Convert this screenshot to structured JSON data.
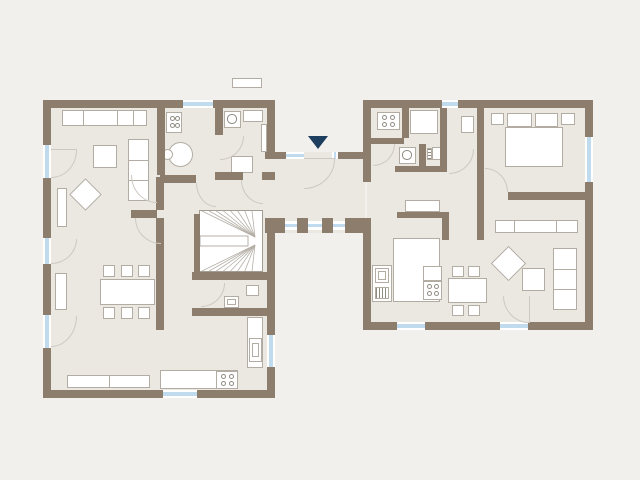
{
  "meta": {
    "description": "architectural floor plan, two building wings joined by a glazed entrance corridor",
    "visible_text": []
  },
  "canvas": {
    "width": 640,
    "height": 480
  },
  "colors": {
    "background": "#f2f0ec",
    "floor": "#ebe8e2",
    "wall": "#8c7d6d",
    "window_glass": "#bfdbed",
    "window_frame": "#ffffff",
    "furniture_fill": "#ffffff",
    "furniture_border": "#b2aca3",
    "symbol_line": "#8f8a82",
    "door_arc": "#cdc8c1",
    "entrance_arrow": "#1e3e5f",
    "stair_line": "#b5afa6",
    "stair_border": "#a39c93"
  },
  "elements": [
    {
      "t": "floor",
      "n": "left-building-floor",
      "x": 47,
      "y": 104,
      "w": 224,
      "h": 290
    },
    {
      "t": "floor",
      "n": "link-corridor-floor",
      "x": 265,
      "y": 152,
      "w": 100,
      "h": 81
    },
    {
      "t": "floor",
      "n": "right-building-floor",
      "x": 367,
      "y": 104,
      "w": 222,
      "h": 222
    },
    {
      "t": "seg",
      "n": "living-sofa",
      "x": 62,
      "y": 110,
      "w": 85,
      "h": 16,
      "dir": "v",
      "segs": [
        0.24,
        0.65,
        0.84
      ]
    },
    {
      "t": "seg",
      "n": "living-sofa-chaise",
      "x": 128,
      "y": 139,
      "w": 21,
      "h": 62,
      "dir": "h",
      "segs": [
        0.33,
        0.66
      ]
    },
    {
      "t": "rect",
      "n": "living-coffee-table",
      "x": 93,
      "y": 145,
      "w": 24,
      "h": 23
    },
    {
      "t": "diamond",
      "n": "living-armchair",
      "x": 74,
      "y": 183,
      "w": 23,
      "h": 23
    },
    {
      "t": "rect",
      "n": "living-radiator",
      "x": 57,
      "y": 188,
      "w": 10,
      "h": 39
    },
    {
      "t": "stove",
      "n": "kitchen1-stove",
      "x": 166,
      "y": 112,
      "w": 16,
      "h": 21
    },
    {
      "t": "circle",
      "n": "kitchen1-round-table",
      "x": 168,
      "y": 142,
      "w": 25,
      "h": 25
    },
    {
      "t": "circle",
      "n": "kitchen1-chair",
      "x": 162,
      "y": 149,
      "w": 11,
      "h": 11
    },
    {
      "t": "washer",
      "n": "utility-washing-machine",
      "x": 224,
      "y": 111,
      "w": 17,
      "h": 17
    },
    {
      "t": "rect",
      "n": "utility-counter",
      "x": 243,
      "y": 110,
      "w": 20,
      "h": 12
    },
    {
      "t": "rect",
      "n": "utility-table",
      "x": 231,
      "y": 156,
      "w": 22,
      "h": 17
    },
    {
      "t": "rect",
      "n": "utility-radiator",
      "x": 261,
      "y": 124,
      "w": 6,
      "h": 28
    },
    {
      "t": "rect",
      "n": "dining-shelf",
      "x": 55,
      "y": 273,
      "w": 12,
      "h": 37
    },
    {
      "t": "rect",
      "n": "dining-table",
      "x": 100,
      "y": 279,
      "w": 55,
      "h": 26
    },
    {
      "t": "rect",
      "n": "dining-chair",
      "x": 103,
      "y": 265,
      "w": 12,
      "h": 12
    },
    {
      "t": "rect",
      "n": "dining-chair",
      "x": 121,
      "y": 265,
      "w": 12,
      "h": 12
    },
    {
      "t": "rect",
      "n": "dining-chair",
      "x": 138,
      "y": 265,
      "w": 12,
      "h": 12
    },
    {
      "t": "rect",
      "n": "dining-chair",
      "x": 103,
      "y": 307,
      "w": 12,
      "h": 12
    },
    {
      "t": "rect",
      "n": "dining-chair",
      "x": 121,
      "y": 307,
      "w": 12,
      "h": 12
    },
    {
      "t": "rect",
      "n": "dining-chair",
      "x": 138,
      "y": 307,
      "w": 12,
      "h": 12
    },
    {
      "t": "seg",
      "n": "dining-sideboard",
      "x": 67,
      "y": 375,
      "w": 83,
      "h": 13,
      "dir": "v",
      "segs": [
        0.5
      ]
    },
    {
      "t": "stairs",
      "n": "staircase",
      "x": 199,
      "y": 210,
      "w": 64,
      "h": 62
    },
    {
      "t": "rect",
      "n": "wc-sink",
      "x": 246,
      "y": 285,
      "w": 13,
      "h": 11
    },
    {
      "t": "inner",
      "n": "wc-toilet",
      "x": 224,
      "y": 296,
      "w": 15,
      "h": 12
    },
    {
      "t": "rect",
      "n": "kitchen2-counter-right",
      "x": 247,
      "y": 317,
      "w": 16,
      "h": 51
    },
    {
      "t": "inner",
      "n": "kitchen2-sink",
      "x": 249,
      "y": 338,
      "w": 13,
      "h": 24
    },
    {
      "t": "rect",
      "n": "kitchen2-counter-bottom",
      "x": 160,
      "y": 370,
      "w": 78,
      "h": 19
    },
    {
      "t": "stove",
      "n": "kitchen2-stove",
      "x": 216,
      "y": 371,
      "w": 22,
      "h": 18
    },
    {
      "t": "rect",
      "n": "roof-dormer",
      "x": 232,
      "y": 78,
      "w": 30,
      "h": 10
    },
    {
      "t": "triangle",
      "n": "entrance-arrow-icon",
      "x": 308,
      "y": 136,
      "w": 20,
      "h": 13
    },
    {
      "t": "stove",
      "n": "kitchen3-stove",
      "x": 377,
      "y": 112,
      "w": 23,
      "h": 18
    },
    {
      "t": "rect",
      "n": "hwr-counter",
      "x": 410,
      "y": 110,
      "w": 28,
      "h": 24
    },
    {
      "t": "grille",
      "n": "hwr-radiator1",
      "x": 404,
      "y": 113,
      "w": 5,
      "h": 16,
      "dir": "h"
    },
    {
      "t": "washer",
      "n": "hwr-washing-machine",
      "x": 399,
      "y": 147,
      "w": 17,
      "h": 17
    },
    {
      "t": "grille",
      "n": "hwr-radiator2",
      "x": 427,
      "y": 148,
      "w": 5,
      "h": 12,
      "dir": "h"
    },
    {
      "t": "rect",
      "n": "hwr-appliance",
      "x": 432,
      "y": 147,
      "w": 14,
      "h": 13
    },
    {
      "t": "rect",
      "n": "bath-shower",
      "x": 461,
      "y": 116,
      "w": 13,
      "h": 17
    },
    {
      "t": "rect",
      "n": "bedroom-nightstand-left",
      "x": 491,
      "y": 113,
      "w": 13,
      "h": 12
    },
    {
      "t": "rect",
      "n": "bedroom-pillow-left",
      "x": 507,
      "y": 113,
      "w": 25,
      "h": 14
    },
    {
      "t": "rect",
      "n": "bedroom-pillow-right",
      "x": 535,
      "y": 113,
      "w": 23,
      "h": 14
    },
    {
      "t": "rect",
      "n": "bedroom-nightstand-right",
      "x": 561,
      "y": 113,
      "w": 14,
      "h": 12
    },
    {
      "t": "rect",
      "n": "bedroom-bed",
      "x": 505,
      "y": 127,
      "w": 58,
      "h": 40
    },
    {
      "t": "rect",
      "n": "hall-bench",
      "x": 405,
      "y": 200,
      "w": 35,
      "h": 12
    },
    {
      "t": "rect",
      "n": "kitchen3-fridge-unit",
      "x": 372,
      "y": 265,
      "w": 20,
      "h": 37
    },
    {
      "t": "inner",
      "n": "kitchen3-fridge",
      "x": 375,
      "y": 268,
      "w": 14,
      "h": 15
    },
    {
      "t": "grille",
      "n": "kitchen3-vent-grille",
      "x": 375,
      "y": 287,
      "w": 14,
      "h": 12,
      "dir": "v"
    },
    {
      "t": "rect",
      "n": "kitchen3-counter",
      "x": 393,
      "y": 238,
      "w": 47,
      "h": 64
    },
    {
      "t": "rect",
      "n": "kitchen3-stove-panel",
      "x": 423,
      "y": 266,
      "w": 19,
      "h": 15
    },
    {
      "t": "stove",
      "n": "kitchen3-cooktop",
      "x": 423,
      "y": 281,
      "w": 19,
      "h": 19
    },
    {
      "t": "rect",
      "n": "dining2-table",
      "x": 448,
      "y": 278,
      "w": 39,
      "h": 25
    },
    {
      "t": "rect",
      "n": "dining2-chair",
      "x": 452,
      "y": 266,
      "w": 12,
      "h": 11
    },
    {
      "t": "rect",
      "n": "dining2-chair",
      "x": 468,
      "y": 266,
      "w": 12,
      "h": 11
    },
    {
      "t": "rect",
      "n": "dining2-chair",
      "x": 452,
      "y": 305,
      "w": 12,
      "h": 11
    },
    {
      "t": "rect",
      "n": "dining2-chair",
      "x": 468,
      "y": 305,
      "w": 12,
      "h": 11
    },
    {
      "t": "seg",
      "n": "living2-wardrobe",
      "x": 495,
      "y": 220,
      "w": 83,
      "h": 13,
      "dir": "v",
      "segs": [
        0.22,
        0.74
      ]
    },
    {
      "t": "diamond",
      "n": "living2-armchair",
      "x": 496,
      "y": 251,
      "w": 25,
      "h": 25
    },
    {
      "t": "rect",
      "n": "living2-coffee-table",
      "x": 522,
      "y": 268,
      "w": 23,
      "h": 23
    },
    {
      "t": "seg",
      "n": "living2-sofa",
      "x": 553,
      "y": 248,
      "w": 24,
      "h": 62,
      "dir": "h",
      "segs": [
        0.33,
        0.66
      ]
    },
    {
      "t": "wall",
      "n": "wall-lb-top",
      "x": 43,
      "y": 100,
      "w": 232,
      "h": 8
    },
    {
      "t": "wall",
      "n": "wall-lb-left",
      "x": 43,
      "y": 100,
      "w": 8,
      "h": 298
    },
    {
      "t": "wall",
      "n": "wall-lb-bottom",
      "x": 43,
      "y": 390,
      "w": 232,
      "h": 8
    },
    {
      "t": "wall",
      "n": "wall-lb-right-upper",
      "x": 267,
      "y": 108,
      "w": 8,
      "h": 44
    },
    {
      "t": "wall",
      "n": "wall-lb-right-lower",
      "x": 267,
      "y": 233,
      "w": 8,
      "h": 157
    },
    {
      "t": "wall",
      "n": "wall-kitchen1-divider",
      "x": 157,
      "y": 108,
      "w": 8,
      "h": 67
    },
    {
      "t": "wall",
      "n": "wall-utility-divider",
      "x": 215,
      "y": 108,
      "w": 8,
      "h": 27
    },
    {
      "t": "wall",
      "n": "wall-utility-south-a",
      "x": 215,
      "y": 172,
      "w": 28,
      "h": 8
    },
    {
      "t": "wall",
      "n": "wall-utility-south-b",
      "x": 262,
      "y": 172,
      "w": 13,
      "h": 8
    },
    {
      "t": "wall",
      "n": "wall-hall-north",
      "x": 160,
      "y": 175,
      "w": 36,
      "h": 8
    },
    {
      "t": "wall",
      "n": "wall-living-dining",
      "x": 131,
      "y": 210,
      "w": 26,
      "h": 8
    },
    {
      "t": "wall",
      "n": "wall-spine-upper",
      "x": 156,
      "y": 177,
      "w": 8,
      "h": 33
    },
    {
      "t": "wall",
      "n": "wall-spine-lower",
      "x": 156,
      "y": 218,
      "w": 8,
      "h": 112
    },
    {
      "t": "wall",
      "n": "wall-stair-west",
      "x": 194,
      "y": 214,
      "w": 6,
      "h": 58
    },
    {
      "t": "wall",
      "n": "wall-stair-south",
      "x": 192,
      "y": 272,
      "w": 83,
      "h": 8
    },
    {
      "t": "wall",
      "n": "wall-wc-south",
      "x": 192,
      "y": 308,
      "w": 83,
      "h": 8
    },
    {
      "t": "wall",
      "n": "wall-corridor-stub-left",
      "x": 265,
      "y": 152,
      "w": 21,
      "h": 7
    },
    {
      "t": "wall",
      "n": "wall-corridor-stub-right",
      "x": 338,
      "y": 152,
      "w": 27,
      "h": 7
    },
    {
      "t": "wall",
      "n": "wall-corridor-pillar1",
      "x": 265,
      "y": 218,
      "w": 20,
      "h": 15
    },
    {
      "t": "wall",
      "n": "wall-corridor-pillar2",
      "x": 297,
      "y": 218,
      "w": 11,
      "h": 15
    },
    {
      "t": "wall",
      "n": "wall-corridor-pillar3",
      "x": 322,
      "y": 218,
      "w": 11,
      "h": 15
    },
    {
      "t": "wall",
      "n": "wall-corridor-pillar4",
      "x": 345,
      "y": 218,
      "w": 20,
      "h": 15
    },
    {
      "t": "wall",
      "n": "wall-rb-top",
      "x": 363,
      "y": 100,
      "w": 230,
      "h": 8
    },
    {
      "t": "wall",
      "n": "wall-rb-left-upper",
      "x": 363,
      "y": 100,
      "w": 8,
      "h": 82
    },
    {
      "t": "wall",
      "n": "wall-rb-left-lower",
      "x": 363,
      "y": 218,
      "w": 8,
      "h": 112
    },
    {
      "t": "wall",
      "n": "wall-rb-right",
      "x": 585,
      "y": 100,
      "w": 8,
      "h": 230
    },
    {
      "t": "wall",
      "n": "wall-rb-bottom",
      "x": 363,
      "y": 322,
      "w": 230,
      "h": 8
    },
    {
      "t": "wall",
      "n": "wall-hwr-divider1",
      "x": 402,
      "y": 108,
      "w": 7,
      "h": 30
    },
    {
      "t": "wall",
      "n": "wall-hwr-h1",
      "x": 371,
      "y": 138,
      "w": 33,
      "h": 6
    },
    {
      "t": "wall",
      "n": "wall-hwr-divider2",
      "x": 419,
      "y": 144,
      "w": 7,
      "h": 22
    },
    {
      "t": "wall",
      "n": "wall-hwr-h2",
      "x": 395,
      "y": 166,
      "w": 45,
      "h": 6
    },
    {
      "t": "wall",
      "n": "wall-bath-west",
      "x": 440,
      "y": 108,
      "w": 7,
      "h": 64
    },
    {
      "t": "wall",
      "n": "wall-rb-spine",
      "x": 477,
      "y": 108,
      "w": 7,
      "h": 132
    },
    {
      "t": "wall",
      "n": "wall-bedroom-south",
      "x": 508,
      "y": 192,
      "w": 85,
      "h": 8
    },
    {
      "t": "wall",
      "n": "wall-hall2-south",
      "x": 397,
      "y": 212,
      "w": 52,
      "h": 6
    },
    {
      "t": "wall",
      "n": "wall-hall2-east",
      "x": 442,
      "y": 212,
      "w": 7,
      "h": 28
    },
    {
      "t": "window",
      "n": "window-lb-top",
      "x": 183,
      "y": 100,
      "w": 30,
      "h": 8
    },
    {
      "t": "window",
      "n": "window-lb-left1",
      "x": 43,
      "y": 145,
      "w": 8,
      "h": 33
    },
    {
      "t": "window",
      "n": "window-lb-left2",
      "x": 43,
      "y": 238,
      "w": 8,
      "h": 26
    },
    {
      "t": "window",
      "n": "window-lb-left3",
      "x": 43,
      "y": 315,
      "w": 8,
      "h": 33
    },
    {
      "t": "window",
      "n": "window-lb-bottom",
      "x": 163,
      "y": 390,
      "w": 34,
      "h": 8
    },
    {
      "t": "window",
      "n": "window-lb-right",
      "x": 267,
      "y": 335,
      "w": 8,
      "h": 32
    },
    {
      "t": "window",
      "n": "entrance-sidelight-left",
      "x": 286,
      "y": 152,
      "w": 18,
      "h": 7
    },
    {
      "t": "window",
      "n": "entrance-sidelight-right",
      "x": 332,
      "y": 152,
      "w": 6,
      "h": 7
    },
    {
      "t": "window",
      "n": "corridor-window1",
      "x": 285,
      "y": 221,
      "w": 12,
      "h": 9
    },
    {
      "t": "window",
      "n": "corridor-window2",
      "x": 308,
      "y": 221,
      "w": 14,
      "h": 9
    },
    {
      "t": "window",
      "n": "corridor-window3",
      "x": 333,
      "y": 221,
      "w": 12,
      "h": 9
    },
    {
      "t": "window",
      "n": "window-rb-top",
      "x": 442,
      "y": 100,
      "w": 16,
      "h": 8
    },
    {
      "t": "window",
      "n": "window-rb-right",
      "x": 585,
      "y": 137,
      "w": 8,
      "h": 45
    },
    {
      "t": "window",
      "n": "window-rb-bottom",
      "x": 397,
      "y": 322,
      "w": 28,
      "h": 8
    },
    {
      "t": "window",
      "n": "door-rb-bottom-glass",
      "x": 500,
      "y": 322,
      "w": 28,
      "h": 8
    },
    {
      "t": "line",
      "n": "door-leaf",
      "x": 51,
      "y": 149,
      "w": 26,
      "h": 1
    },
    {
      "t": "arc",
      "n": "door-arc",
      "x": 51,
      "y": 150,
      "w": 26,
      "h": 28,
      "c": "br"
    },
    {
      "t": "arc",
      "n": "door-arc",
      "x": 51,
      "y": 239,
      "w": 26,
      "h": 25,
      "c": "br"
    },
    {
      "t": "arc",
      "n": "door-arc",
      "x": 51,
      "y": 316,
      "w": 26,
      "h": 31,
      "c": "br"
    },
    {
      "t": "arc",
      "n": "door-arc",
      "x": 131,
      "y": 175,
      "w": 26,
      "h": 28,
      "c": "bl"
    },
    {
      "t": "arc",
      "n": "door-arc",
      "x": 220,
      "y": 136,
      "w": 24,
      "h": 24,
      "c": "br"
    },
    {
      "t": "arc",
      "n": "door-arc",
      "x": 241,
      "y": 180,
      "w": 22,
      "h": 24,
      "c": "bl"
    },
    {
      "t": "arc",
      "n": "door-arc",
      "x": 196,
      "y": 183,
      "w": 20,
      "h": 24,
      "c": "bl"
    },
    {
      "t": "arc",
      "n": "door-arc",
      "x": 135,
      "y": 218,
      "w": 26,
      "h": 26,
      "c": "bl"
    },
    {
      "t": "arc",
      "n": "door-arc",
      "x": 201,
      "y": 283,
      "w": 24,
      "h": 24,
      "c": "br"
    },
    {
      "t": "line",
      "n": "entrance-door-leaf",
      "x": 304,
      "y": 158,
      "w": 31,
      "h": 1
    },
    {
      "t": "arc",
      "n": "entrance-door-arc",
      "x": 304,
      "y": 159,
      "w": 31,
      "h": 30,
      "c": "br"
    },
    {
      "t": "arc",
      "n": "door-arc",
      "x": 373,
      "y": 144,
      "w": 22,
      "h": 22,
      "c": "br"
    },
    {
      "t": "arc",
      "n": "door-arc",
      "x": 449,
      "y": 149,
      "w": 25,
      "h": 25,
      "c": "br"
    },
    {
      "t": "arc",
      "n": "door-arc",
      "x": 485,
      "y": 168,
      "w": 23,
      "h": 24,
      "c": "tr"
    },
    {
      "t": "line",
      "n": "door-leaf",
      "x": 529,
      "y": 296,
      "w": 1,
      "h": 27
    },
    {
      "t": "arc",
      "n": "door-arc",
      "x": 503,
      "y": 296,
      "w": 26,
      "h": 27,
      "c": "bl"
    }
  ]
}
